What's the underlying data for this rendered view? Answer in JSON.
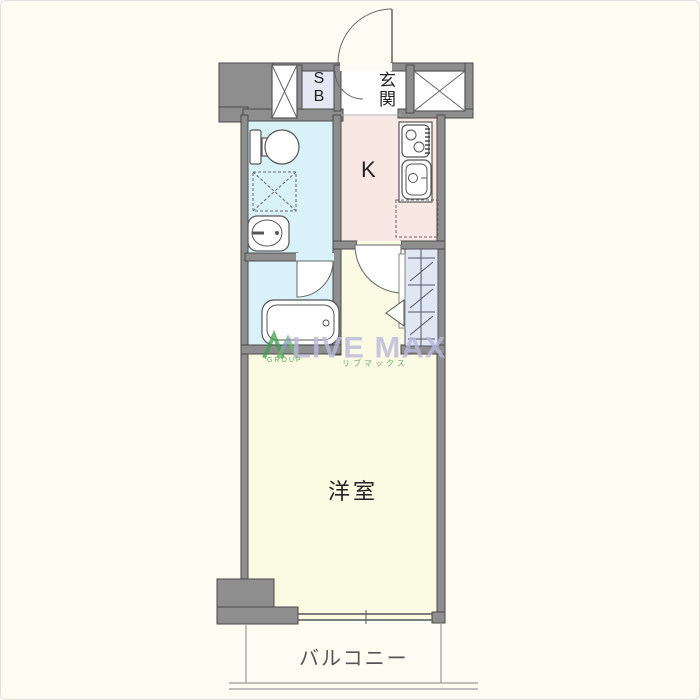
{
  "plan_title": "one-room apartment floor plan",
  "rooms": {
    "entrance": {
      "label": "玄関"
    },
    "shoe_box": {
      "label": "SB"
    },
    "kitchen": {
      "label": "K"
    },
    "western_room": {
      "label": "洋室"
    },
    "balcony": {
      "label": "バルコニー"
    }
  },
  "fixtures": [
    "front-door",
    "pipe-space-left",
    "pipe-space-right",
    "toilet",
    "washing-machine-space",
    "washbasin",
    "bathtub",
    "bathroom-door",
    "stove",
    "kitchen-sink",
    "refrigerator-space",
    "closet",
    "closet-folding-door",
    "room-door",
    "sliding-window"
  ],
  "watermark": {
    "brand": "LIVE MAX",
    "brand_sub": "GROUP",
    "brand_kana": "リブマックス"
  },
  "colors": {
    "background": "#fcfcf2",
    "wall": "#8e8e8e",
    "wall_border": "#4a4a4a",
    "wet_area": "#d9f1f8",
    "kitchen": "#f9e7e3",
    "room": "#fbfae2",
    "shoe_box": "#e6e6f4",
    "closet": "#dfe7f2",
    "watermark_purple": "#b9b9dd",
    "watermark_green": "#3f9e4d"
  }
}
